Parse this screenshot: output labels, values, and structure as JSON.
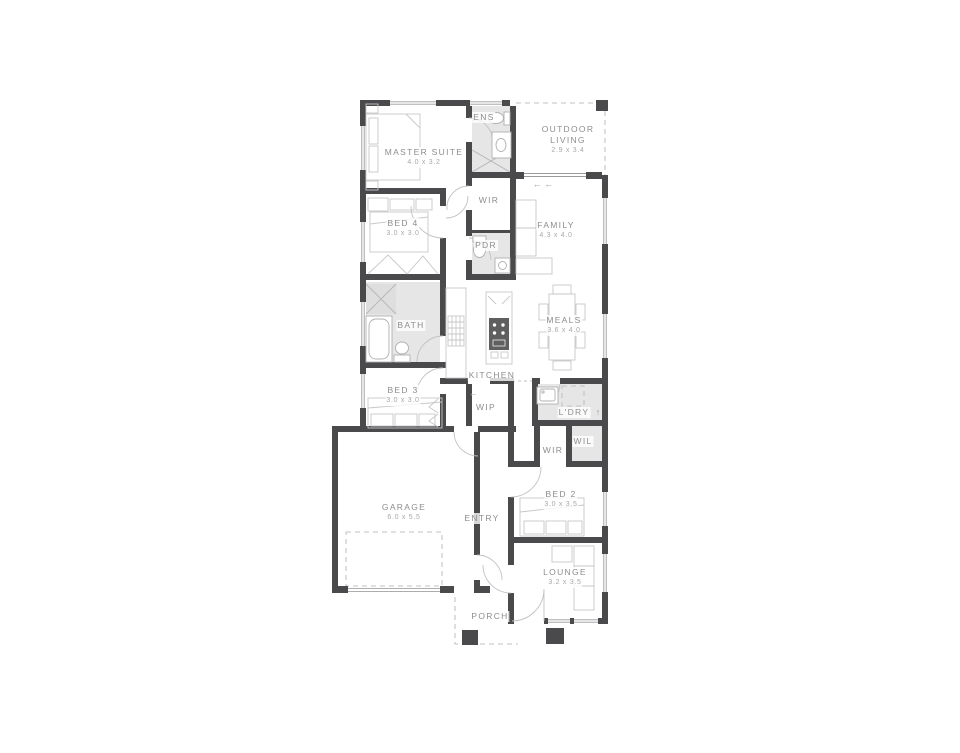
{
  "palette": {
    "wall": "#4a4a4d",
    "wet_area": "#e6e6e6",
    "furniture_line": "#c7c7c7",
    "door_line": "#c2c2c2",
    "label": "#8d8d8d",
    "dims": "#a8a8a8",
    "background": "#ffffff"
  },
  "icons": {
    "sliding_door_arrows": "←  ←",
    "wip_entry_arrow": "←",
    "laundry_exit_arrow": "↑"
  },
  "rooms": {
    "master_suite": {
      "name": "MASTER SUITE",
      "dims": "4.0 x 3.2"
    },
    "ens": {
      "name": "ENS"
    },
    "outdoor_living": {
      "name": "OUTDOOR LIVING",
      "dims": "2.9 x 3.4"
    },
    "bed4": {
      "name": "BED 4",
      "dims": "3.0 x 3.0"
    },
    "wir_hall": {
      "name": "WIR"
    },
    "pdr": {
      "name": "PDR"
    },
    "family": {
      "name": "FAMILY",
      "dims": "4.3 x 4.0"
    },
    "bath": {
      "name": "BATH"
    },
    "kitchen": {
      "name": "KITCHEN"
    },
    "meals": {
      "name": "MEALS",
      "dims": "3.6 x 4.0"
    },
    "bed3": {
      "name": "BED 3",
      "dims": "3.0 x 3.0"
    },
    "wip": {
      "name": "WIP"
    },
    "ldry": {
      "name": "L'DRY"
    },
    "wir_bed2": {
      "name": "WIR"
    },
    "wil": {
      "name": "WIL"
    },
    "garage": {
      "name": "GARAGE",
      "dims": "6.0 x 5.5"
    },
    "entry": {
      "name": "ENTRY"
    },
    "bed2": {
      "name": "BED 2",
      "dims": "3.0 x 3.5"
    },
    "lounge": {
      "name": "LOUNGE",
      "dims": "3.2 x 3.5"
    },
    "porch": {
      "name": "PORCH"
    }
  }
}
